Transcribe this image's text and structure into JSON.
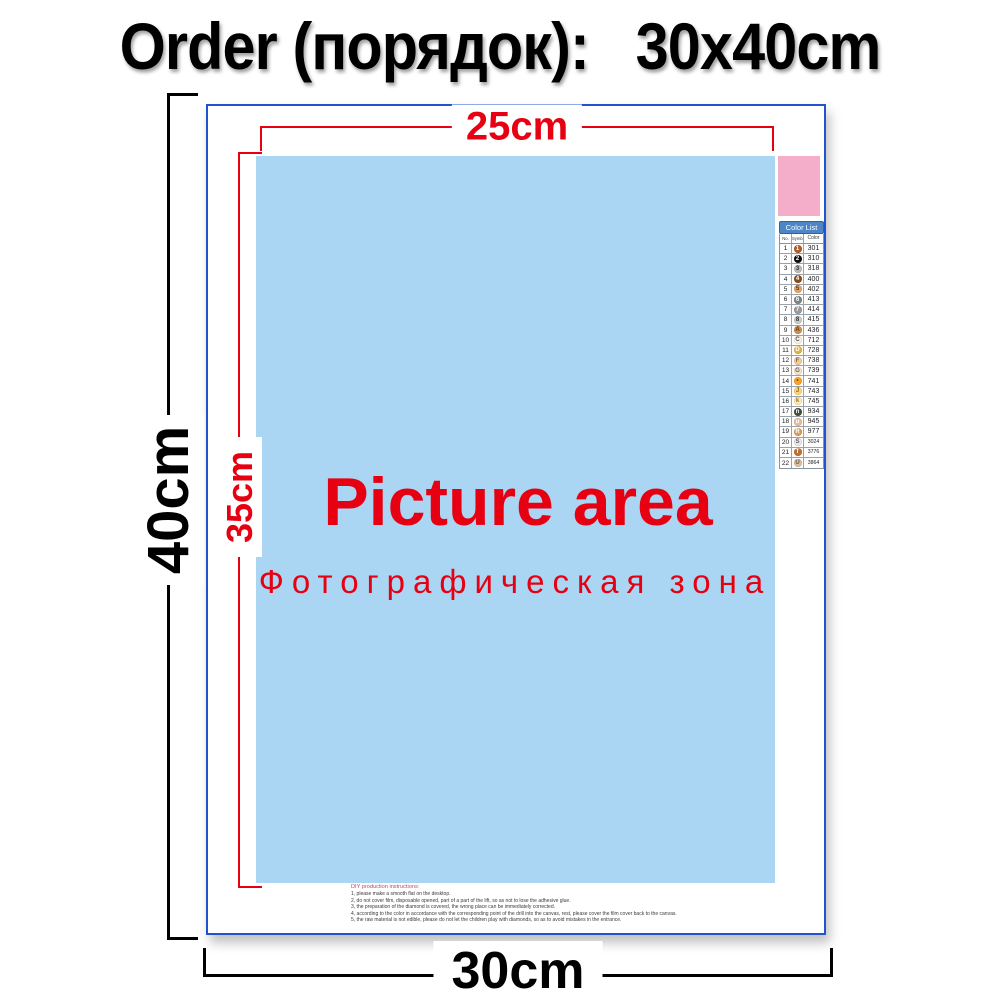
{
  "title": "Order (порядок):   30x40cm",
  "dimensions": {
    "top": "25cm",
    "left_outer": "40cm",
    "left_inner": "35cm",
    "bottom": "30cm"
  },
  "picture_area": {
    "heading": "Picture area",
    "subheading": "Фотографическая зона"
  },
  "instructions": {
    "heading": "DIY production instructions:",
    "lines": [
      "1, please make a smooth flat on the desktop.",
      "2, do not cover film, disposable opened, part of a part of the lift, so as not to lose the adhesive glue.",
      "3, the preparation of the diamond is covered, the wrong place can be immediately corrected.",
      "4, according to the color in accordance with the corresponding point of the drill into the canvas, rest, please cover the film cover back to the canvas.",
      "5, the raw material is not edible, please do not let the children play with diamonds, so as to avoid mistakes in the entrance."
    ]
  },
  "color_list": {
    "header": "Color List",
    "columns": [
      "No.",
      "Symbol",
      "Color"
    ],
    "rows": [
      {
        "no": "1",
        "symbol": "1",
        "code": "301",
        "circle": "#b05c2a",
        "text": "#ffffff"
      },
      {
        "no": "2",
        "symbol": "2",
        "code": "310",
        "circle": "#111111",
        "text": "#ffffff"
      },
      {
        "no": "3",
        "symbol": "3",
        "code": "318",
        "circle": "#b9babc",
        "text": "#333333"
      },
      {
        "no": "4",
        "symbol": "4",
        "code": "400",
        "circle": "#8e4a13",
        "text": "#ffffff"
      },
      {
        "no": "5",
        "symbol": "5",
        "code": "402",
        "circle": "#e3a36a",
        "text": "#5a3510"
      },
      {
        "no": "6",
        "symbol": "6",
        "code": "413",
        "circle": "#7d8382",
        "text": "#ffffff"
      },
      {
        "no": "7",
        "symbol": "7",
        "code": "414",
        "circle": "#9a9a9a",
        "text": "#ffffff"
      },
      {
        "no": "8",
        "symbol": "8",
        "code": "415",
        "circle": "#c9cacc",
        "text": "#333333"
      },
      {
        "no": "9",
        "symbol": "A",
        "code": "436",
        "circle": "#cb9051",
        "text": "#6b3a0e"
      },
      {
        "no": "10",
        "symbol": "C",
        "code": "712",
        "circle": "#f7f3e3",
        "text": "#555555"
      },
      {
        "no": "11",
        "symbol": "D",
        "code": "728",
        "circle": "#e4b23c",
        "text": "#ffffff"
      },
      {
        "no": "12",
        "symbol": "F",
        "code": "738",
        "circle": "#eccc9e",
        "text": "#8a6a3a"
      },
      {
        "no": "13",
        "symbol": "G",
        "code": "739",
        "circle": "#f6e2c6",
        "text": "#666666"
      },
      {
        "no": "14",
        "symbol": "•",
        "code": "741",
        "circle": "#f9a32b",
        "text": "#7a4a00"
      },
      {
        "no": "15",
        "symbol": "J",
        "code": "743",
        "circle": "#fed376",
        "text": "#8a6a10"
      },
      {
        "no": "16",
        "symbol": "k",
        "code": "745",
        "circle": "#ffe9ad",
        "text": "#8a7a30"
      },
      {
        "no": "17",
        "symbol": "n",
        "code": "934",
        "circle": "#43513a",
        "text": "#ffffff"
      },
      {
        "no": "18",
        "symbol": "u",
        "code": "945",
        "circle": "#e9bd93",
        "text": "#ffffff"
      },
      {
        "no": "19",
        "symbol": "R",
        "code": "977",
        "circle": "#dc9c56",
        "text": "#ffffff"
      },
      {
        "no": "20",
        "symbol": "S",
        "code": "3024",
        "circle": "#e9e8e4",
        "text": "#666666"
      },
      {
        "no": "21",
        "symbol": "T",
        "code": "3776",
        "circle": "#c0702f",
        "text": "#ffffff"
      },
      {
        "no": "22",
        "symbol": "U",
        "code": "3864",
        "circle": "#d9bfa5",
        "text": "#6a5a45"
      }
    ]
  },
  "colors": {
    "accent_red": "#e60012",
    "canvas_border_blue": "#2053cf",
    "picture_area_blue": "#abd6f3",
    "pink_swatch": "#f4aeca",
    "color_list_header_bg": "#4d86c6"
  }
}
